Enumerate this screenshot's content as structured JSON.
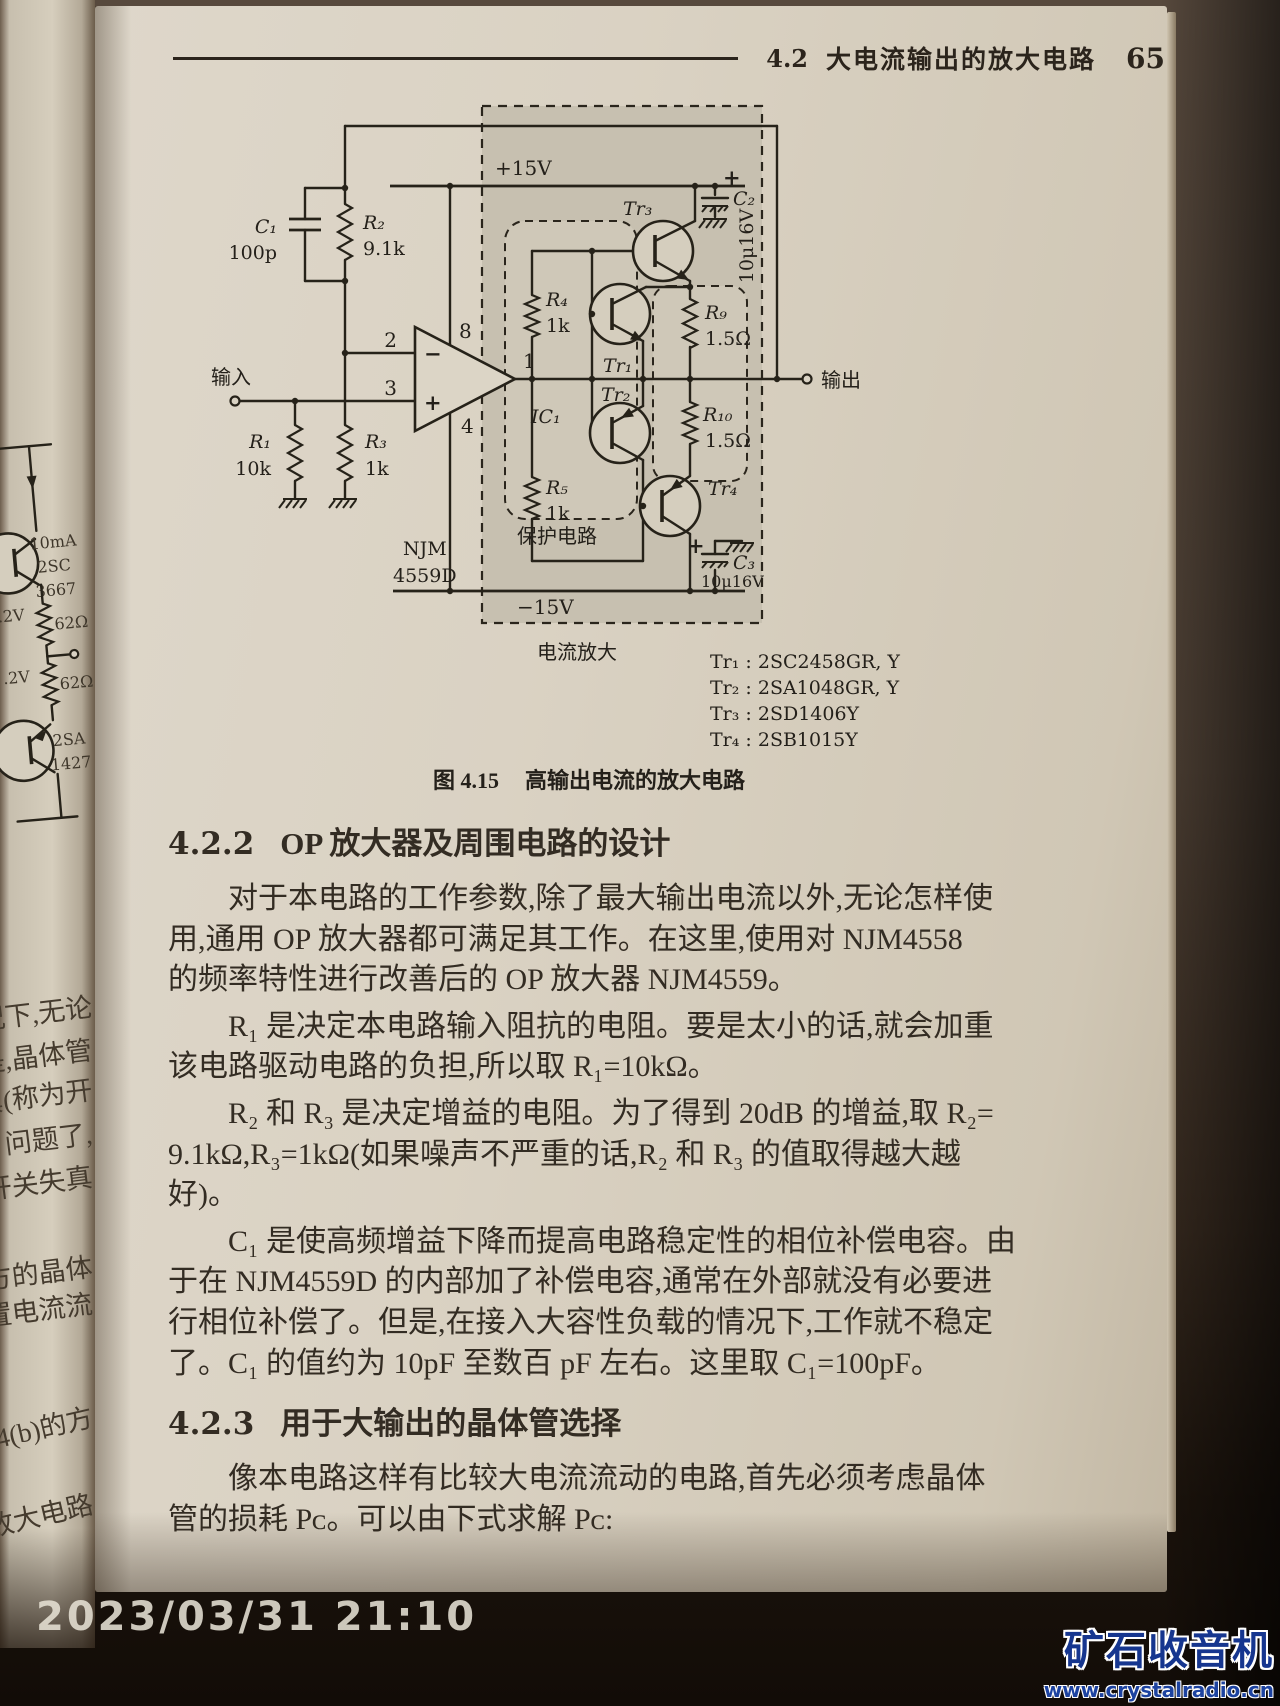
{
  "photo": {
    "timestamp": "2023/03/31 21:10",
    "watermark": {
      "title": "矿石收音机",
      "url": "www.crystalradio.cn"
    }
  },
  "left_page": {
    "circuit": {
      "current": "10mA",
      "tr_top": "2SC",
      "tr_top2": "3667",
      "res1": "62Ω",
      "res2": "62Ω",
      "v1": ".2V",
      "v2": ".2V",
      "tr_bot": "2SA",
      "tr_bot2": "1427"
    },
    "fragments": [
      "况下,无论",
      "是,晶体管",
      "真(称为开",
      "问题了,",
      "开关失真",
      "方的晶体",
      "置电流流",
      "4(b)的方",
      "放大电路"
    ]
  },
  "page": {
    "header": {
      "section_no": "4.2",
      "title": "大电流输出的放大电路",
      "page_no": "65"
    },
    "figure": {
      "caption_no": "图 4.15",
      "caption_text": "高输出电流的放大电路",
      "sch": {
        "vplus": "+15V",
        "vminus": "−15V",
        "in": "输入",
        "out": "输出",
        "prot": "保护电路",
        "camp": "电流放大",
        "c1": "C₁",
        "c1v": "100p",
        "r2": "R₂",
        "r2v": "9.1k",
        "r1": "R₁",
        "r1v": "10k",
        "r3": "R₃",
        "r3v": "1k",
        "p2": "2",
        "p3": "3",
        "p8": "8",
        "p4": "4",
        "p1": "1",
        "minus": "−",
        "plus": "+",
        "ic": "IC₁",
        "icn1": "NJM",
        "icn2": "4559D",
        "r4": "R₄",
        "r4v": "1k",
        "r5": "R₅",
        "r5v": "1k",
        "r9": "R₉",
        "r9v": "1.5Ω",
        "r10": "R₁₀",
        "r10v": "1.5Ω",
        "tr1": "Tr₁",
        "tr2": "Tr₂",
        "tr3": "Tr₃",
        "tr4": "Tr₄",
        "c2": "C₂",
        "c2v": "10μ16V",
        "c2plus": "+",
        "c3": "C₃",
        "c3v": "10μ16V",
        "c3plus": "+"
      },
      "tr_list": [
        "Tr₁ : 2SC2458GR, Y",
        "Tr₂ : 2SA1048GR, Y",
        "Tr₃ : 2SD1406Y",
        "Tr₄ : 2SB1015Y"
      ]
    },
    "sections": [
      {
        "no": "4.2.2",
        "title": "OP 放大器及周围电路的设计",
        "paragraphs": [
          {
            "lines": [
              "对于本电路的工作参数,除了最大输出电流以外,无论怎样使",
              "用,通用 OP 放大器都可满足其工作。在这里,使用对 NJM4558",
              "的频率特性进行改善后的 OP 放大器 NJM4559。"
            ]
          },
          {
            "lines": [
              "R₁ 是决定本电路输入阻抗的电阻。要是太小的话,就会加重",
              "该电路驱动电路的负担,所以取 R₁=10kΩ。"
            ]
          },
          {
            "lines": [
              "R₂ 和 R₃ 是决定增益的电阻。为了得到 20dB 的增益,取 R₂=",
              "9.1kΩ,R₃=1kΩ(如果噪声不严重的话,R₂ 和 R₃ 的值取得越大越",
              "好)。"
            ]
          },
          {
            "lines": [
              "C₁ 是使高频增益下降而提高电路稳定性的相位补偿电容。由",
              "于在 NJM4559D 的内部加了补偿电容,通常在外部就没有必要进",
              "行相位补偿了。但是,在接入大容性负载的情况下,工作就不稳定",
              "了。C₁ 的值约为 10pF 至数百 pF 左右。这里取 C₁=100pF。"
            ]
          }
        ]
      },
      {
        "no": "4.2.3",
        "title": "用于大输出的晶体管选择",
        "paragraphs": [
          {
            "lines": [
              "像本电路这样有比较大电流流动的电路,首先必须考虑晶体",
              "管的损耗 Pᴄ。可以由下式求解 Pᴄ:"
            ]
          }
        ]
      }
    ]
  }
}
